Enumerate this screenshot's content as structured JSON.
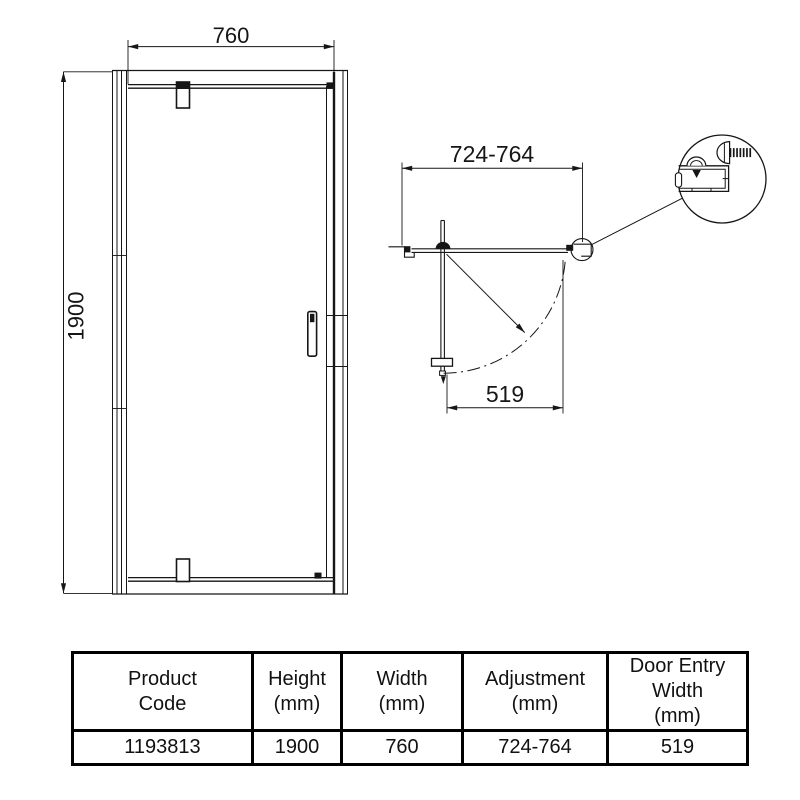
{
  "page": {
    "background": "#ffffff",
    "line_color": "#161616"
  },
  "drawing": {
    "front_elevation": {
      "width_label": "760",
      "height_label": "1900"
    },
    "plan_view": {
      "adjustment_label": "724-764",
      "door_entry_label": "519"
    }
  },
  "table": {
    "headers": [
      {
        "label": "Product Code",
        "lines": [
          "Product",
          "Code"
        ]
      },
      {
        "label": "Height (mm)",
        "lines": [
          "Height",
          "(mm)"
        ]
      },
      {
        "label": "Width (mm)",
        "lines": [
          "Width",
          "(mm)"
        ]
      },
      {
        "label": "Adjustment (mm)",
        "lines": [
          "Adjustment",
          "(mm)"
        ]
      },
      {
        "label": "Door Entry Width (mm)",
        "lines": [
          "Door Entry",
          "Width",
          "(mm)"
        ]
      }
    ],
    "values": [
      "1193813",
      "1900",
      "760",
      "724-764",
      "519"
    ]
  }
}
